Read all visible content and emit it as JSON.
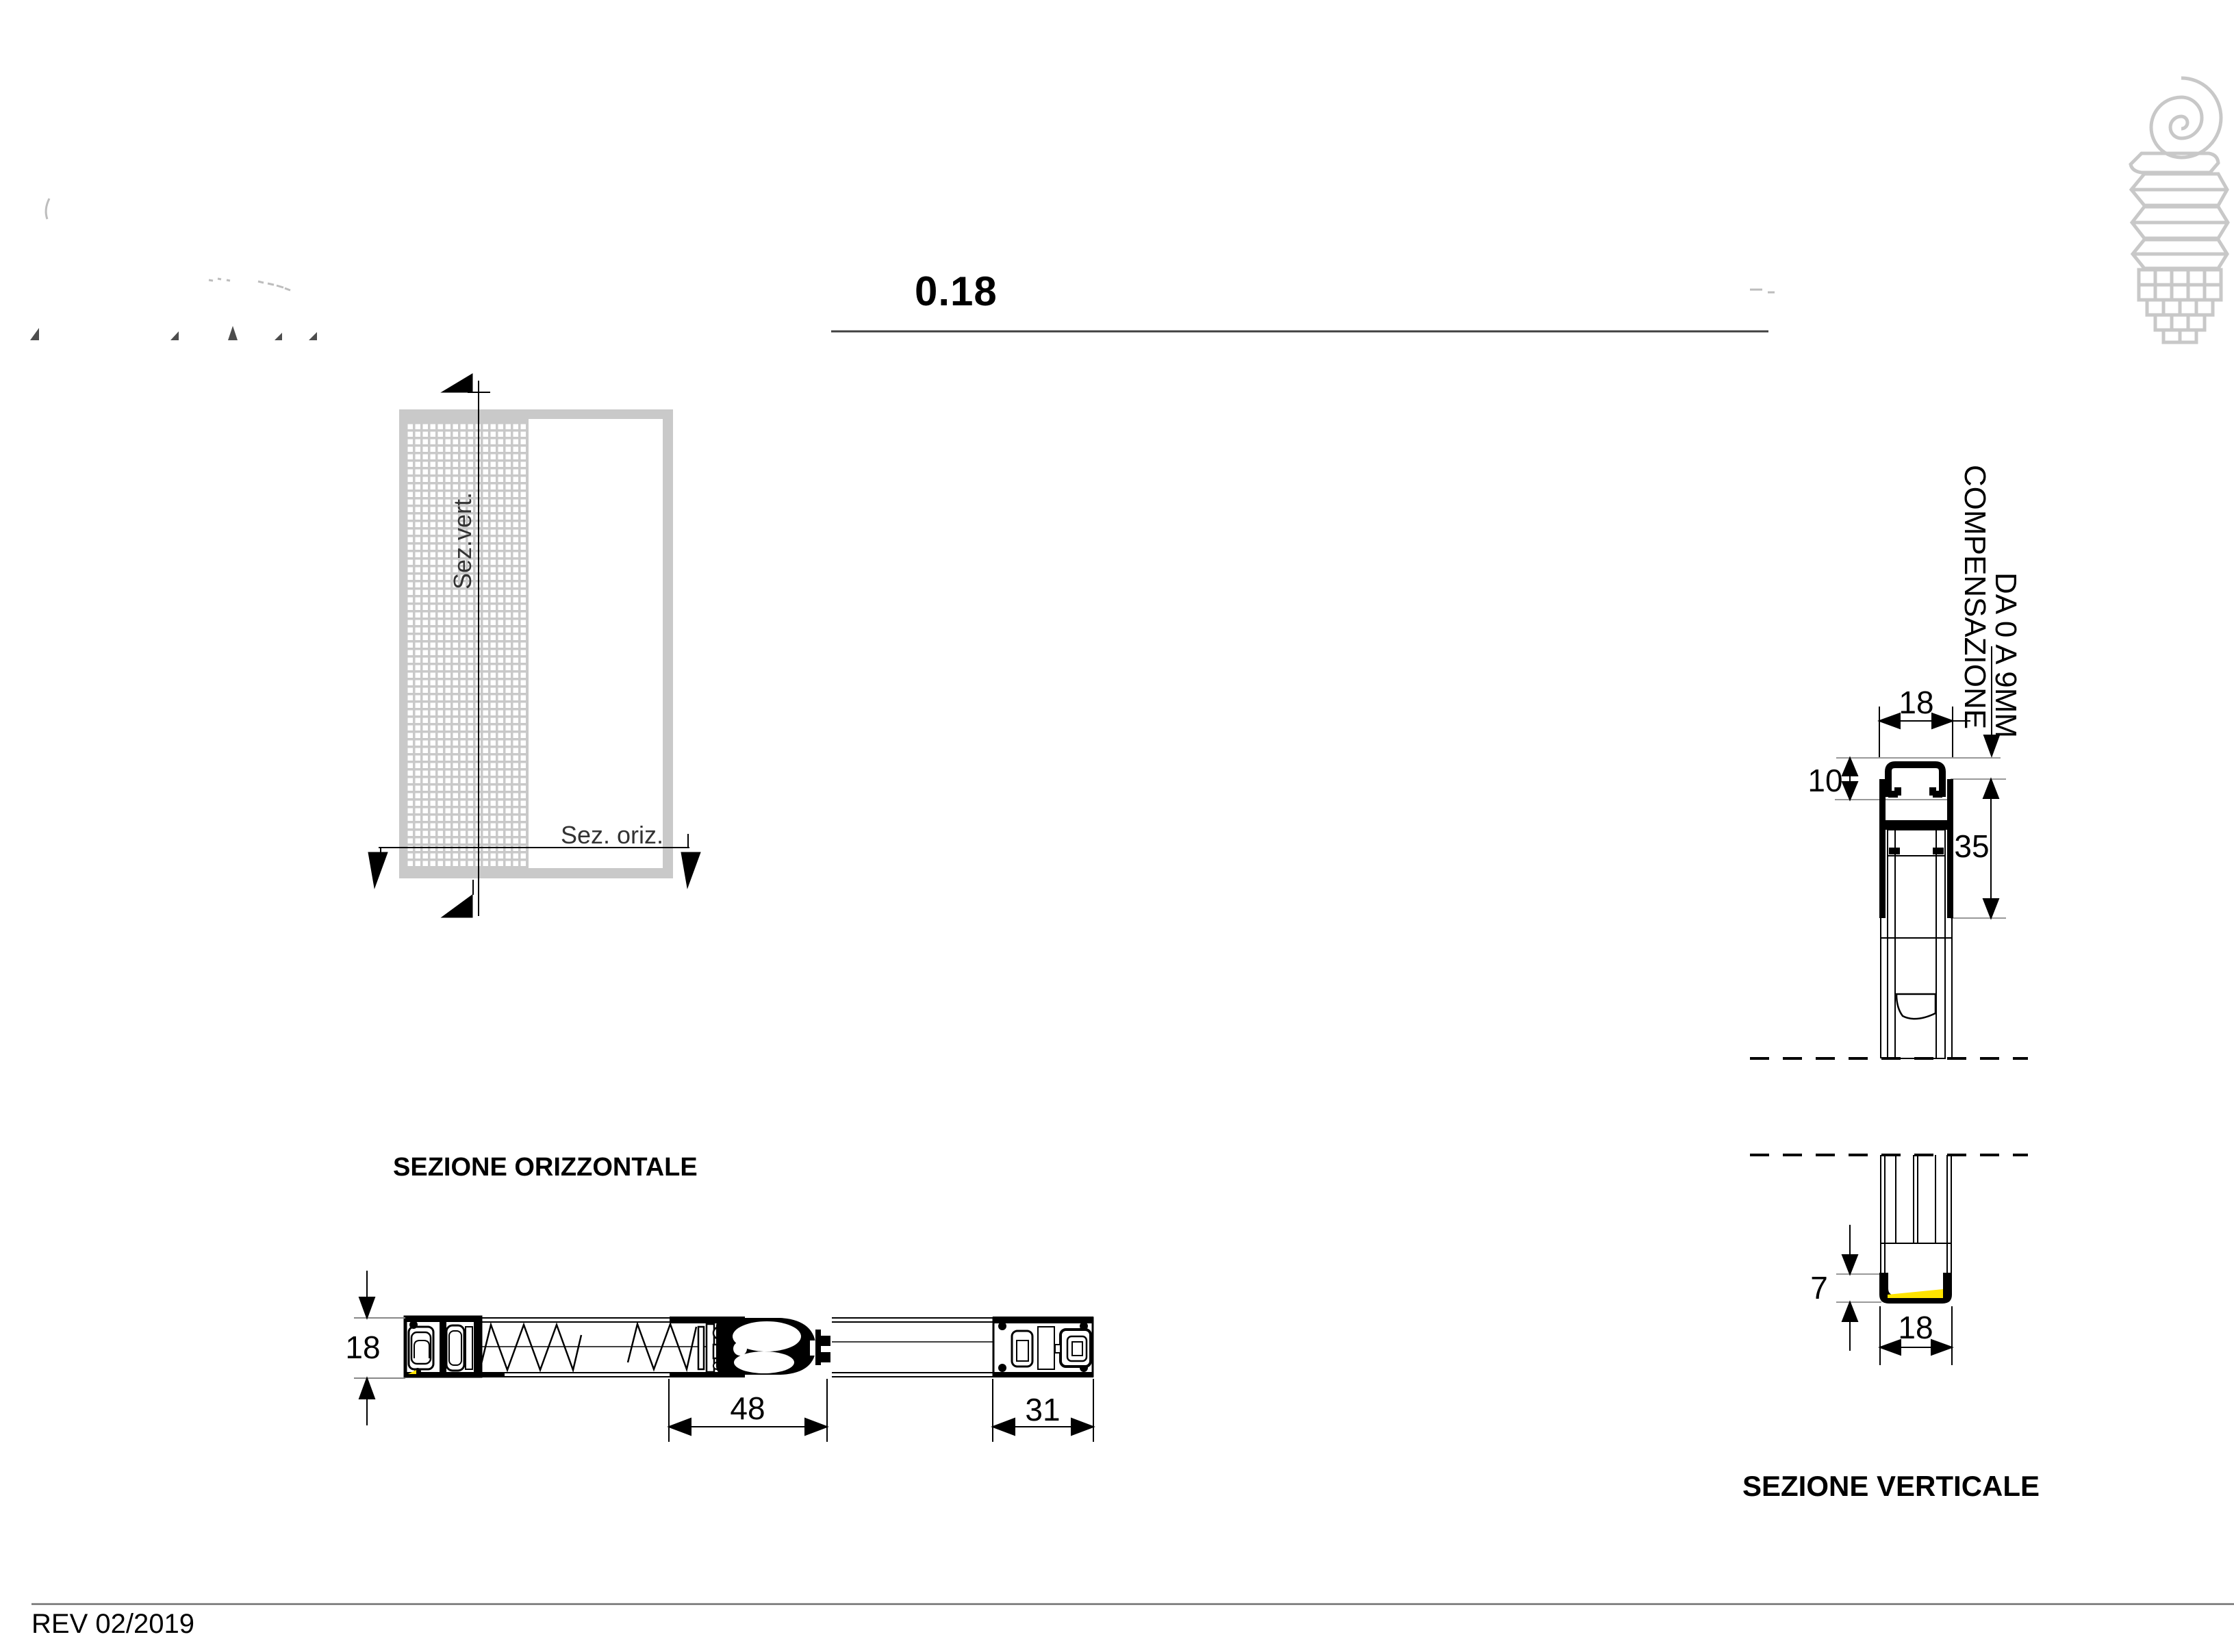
{
  "sheet": {
    "title": "0.18",
    "revision": "REV 02/2019"
  },
  "plan": {
    "cut_label_vertical": "Sez.vert.",
    "cut_label_horizontal": "Sez. oriz."
  },
  "horizontal_section": {
    "title": "SEZIONE ORIZZONTALE",
    "dim_frame_depth": "18",
    "dim_cassette_width": "48",
    "dim_guide_width": "31"
  },
  "vertical_section": {
    "title": "SEZIONE VERTICALE",
    "compensation_line1": "COMPENSAZIONE",
    "compensation_line2": "DA 0 A 9MM",
    "dim_track_width": "18",
    "dim_track_height": "10",
    "dim_overlap": "35",
    "dim_bottom_height": "7",
    "dim_bottom_width": "18"
  },
  "logo_icon": "spiral-ribbon-grid-logo-icon",
  "colors": {
    "line_black": "#000000",
    "frame_gray": "#c9c9c9",
    "logo_gray": "#c8c8c8",
    "dim_gray": "#999999",
    "accent_yellow": "#ffe400"
  }
}
